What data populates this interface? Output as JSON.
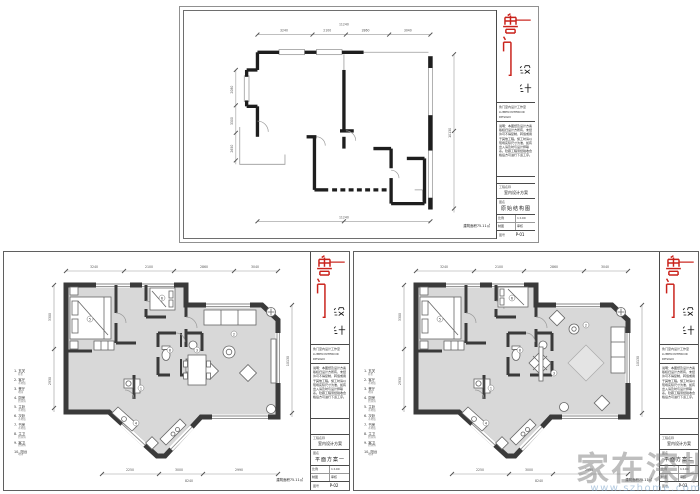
{
  "page": {
    "width": 700,
    "height": 494,
    "background": "#ffffff"
  },
  "colors": {
    "wall_structure": "#1e1e1e",
    "wall_plan": "#3a3a3a",
    "floor_fill": "#d8d8d8",
    "accent_red": "#c9211a",
    "dim_line": "#8a8a8a",
    "watermark_gray": "#7d7d7d",
    "watermark_blue": "#82a8cd"
  },
  "logo": {
    "red_char_1": "鲁",
    "red_char_2": "门",
    "black_char_1": "设",
    "black_char_2": "计"
  },
  "titleblock": {
    "info_line_1": "鲁门室内设计工作室",
    "info_line_2": "LUMEN INTERIOR DESIGN",
    "notes": "说明：本图纸及设计方案版权归设计方所有，未经许可不得复制、转载或用于其他工程。施工时请以现场实际尺寸为准，如有出入请及时与设计师联系。隐蔽工程须经验收合格后方可进行下道工序。",
    "project_label": "工程名称",
    "project_value": "室内设计方案",
    "name_label": "图名",
    "scale_label": "比例",
    "scale_value": "1:100",
    "date_label": "日期",
    "draw_label": "制图",
    "check_label": "审核",
    "no_label": "图号"
  },
  "sheets": {
    "structure": {
      "drawing_name": "原始结构图",
      "drawing_no": "P-01",
      "area_note": "建筑面积75.11㎡"
    },
    "plan_a": {
      "drawing_name": "平面方案一",
      "drawing_no": "P-02",
      "area_note": "建筑面积75.11㎡"
    },
    "plan_b": {
      "drawing_name": "平面方案二",
      "drawing_no": "P-03",
      "area_note": "建筑面积75.11㎡"
    }
  },
  "legend": {
    "items": [
      {
        "no": "1",
        "name": "玄关",
        "sub": "鞋柜"
      },
      {
        "no": "2",
        "name": "客厅",
        "sub": "木地板"
      },
      {
        "no": "3",
        "name": "餐厅",
        "sub": "地砖"
      },
      {
        "no": "4",
        "name": "厨房",
        "sub": "防滑砖"
      },
      {
        "no": "5",
        "name": "主卧",
        "sub": "木地板"
      },
      {
        "no": "6",
        "name": "次卧",
        "sub": "木地板"
      },
      {
        "no": "7",
        "name": "书房",
        "sub": "木地板"
      },
      {
        "no": "8",
        "name": "主卫",
        "sub": "防滑砖"
      },
      {
        "no": "9",
        "name": "客卫",
        "sub": "防滑砖"
      },
      {
        "no": "10",
        "name": "阳台",
        "sub": "地砖"
      }
    ]
  },
  "dims": {
    "structure": {
      "top_parts": [
        "3240",
        "2100",
        "2860",
        "3040"
      ],
      "top_total": "11240",
      "right_total": "10130",
      "bottom_total": "11240",
      "left_parts": [
        "2080",
        "3300",
        "2650"
      ]
    },
    "plan": {
      "top_parts": [
        "3240",
        "2100",
        "2860",
        "3040"
      ],
      "right_total": "10130",
      "bottom_parts": [
        "2250",
        "3000",
        "2990"
      ],
      "bottom_total": "8240",
      "left_parts": [
        "3300",
        "2930"
      ]
    }
  },
  "rooms": {
    "numbers": [
      "1",
      "2",
      "3",
      "4",
      "5",
      "6",
      "7",
      "8",
      "9",
      "10"
    ]
  },
  "watermark": {
    "text": "家在深圳",
    "url": "www.szhome.com"
  }
}
